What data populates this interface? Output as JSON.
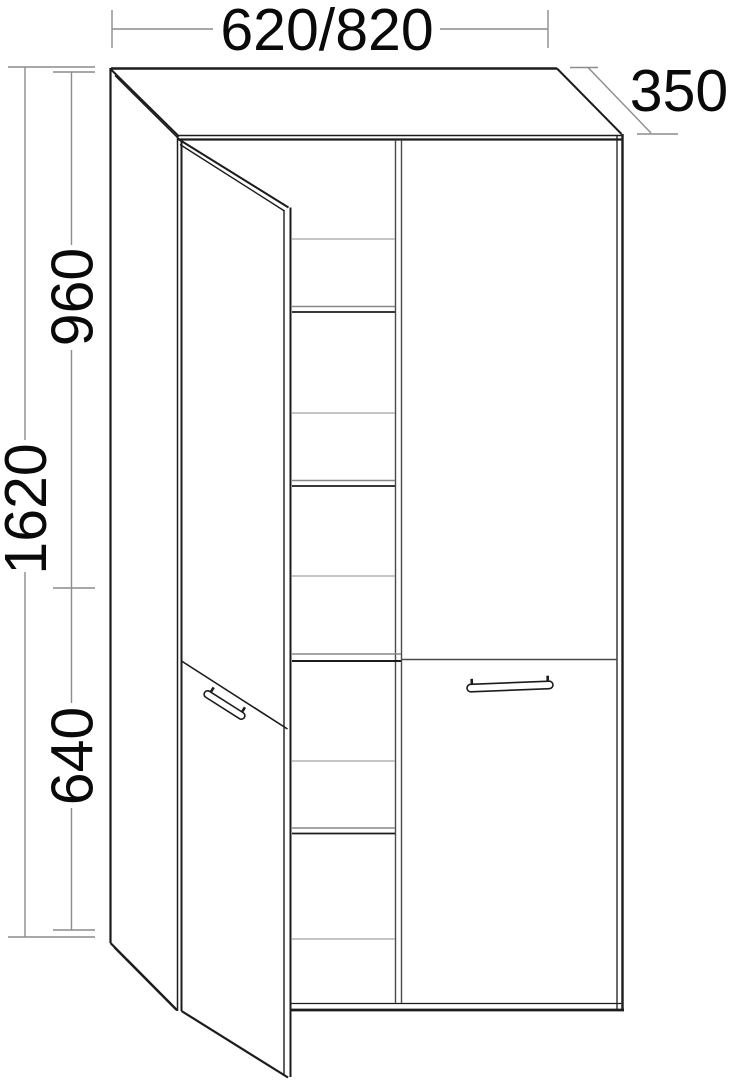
{
  "drawing_title": "tall-cabinet-technical-drawing",
  "dimensions": {
    "width": {
      "label": "620/820"
    },
    "depth": {
      "label": "350"
    },
    "height": {
      "label": "1620"
    },
    "upper_section": {
      "label": "960"
    },
    "lower_section": {
      "label": "640"
    }
  },
  "drawing": {
    "colors": {
      "black": "#1c1c1c",
      "dark": "#4a4a4a",
      "gray": "#8c8c8c",
      "shelf": "#a2a2a2",
      "shelfdark": "#878787",
      "background": "#ffffff",
      "text": "#0a0a0a"
    },
    "lines": [
      {
        "n": "top-back-edge",
        "x1": 111,
        "y1": 68.5,
        "x2": 557,
        "y2": 68.5,
        "w": 2.5,
        "c": "black"
      },
      {
        "n": "left-back-edge",
        "x1": 110.5,
        "y1": 68,
        "x2": 110.5,
        "y2": 943,
        "w": 2.2,
        "c": "black"
      },
      {
        "n": "top-left-diagonal-outer",
        "x1": 111,
        "y1": 69.5,
        "x2": 179,
        "y2": 136.5,
        "w": 2,
        "c": "black"
      },
      {
        "n": "top-left-diagonal-inner",
        "x1": 115,
        "y1": 75.5,
        "x2": 180,
        "y2": 140,
        "w": 1.5,
        "c": "black"
      },
      {
        "n": "front-top-edge-upper",
        "x1": 178,
        "y1": 135.5,
        "x2": 622,
        "y2": 135.5,
        "w": 1.5,
        "c": "black"
      },
      {
        "n": "front-top-edge-lower",
        "x1": 178,
        "y1": 139.5,
        "x2": 622,
        "y2": 139.5,
        "w": 2.2,
        "c": "black"
      },
      {
        "n": "top-right-diagonal",
        "x1": 557,
        "y1": 68.5,
        "x2": 621.5,
        "y2": 134,
        "w": 2,
        "c": "black"
      },
      {
        "n": "front-right-edge-inner",
        "x1": 617,
        "y1": 135.5,
        "x2": 617,
        "y2": 1009,
        "w": 1.3,
        "c": "black"
      },
      {
        "n": "front-right-edge-outer",
        "x1": 622.5,
        "y1": 134,
        "x2": 622.5,
        "y2": 1011,
        "w": 2.4,
        "c": "black"
      },
      {
        "n": "front-bottom-edge-upper",
        "x1": 291.5,
        "y1": 1003.5,
        "x2": 622.5,
        "y2": 1003.5,
        "w": 1.3,
        "c": "black"
      },
      {
        "n": "front-bottom-edge-lower",
        "x1": 291.5,
        "y1": 1010,
        "x2": 624,
        "y2": 1010,
        "w": 2.8,
        "c": "black"
      },
      {
        "n": "front-left-edge-outer",
        "x1": 177.5,
        "y1": 136,
        "x2": 177.5,
        "y2": 1011,
        "w": 1.5,
        "c": "black"
      },
      {
        "n": "front-left-edge-inner",
        "x1": 181.5,
        "y1": 140,
        "x2": 181.5,
        "y2": 1011,
        "w": 2,
        "c": "black"
      },
      {
        "n": "side-bottom-diagonal-outer",
        "x1": 110.5,
        "y1": 943,
        "x2": 177.5,
        "y2": 1010.5,
        "w": 2.2,
        "c": "black"
      },
      {
        "n": "side-bottom-diagonal-inner",
        "x1": 114,
        "y1": 947.5,
        "x2": 176,
        "y2": 1010,
        "w": 1.4,
        "c": "black"
      },
      {
        "n": "door-top-edge-outer",
        "x1": 179,
        "y1": 139.5,
        "x2": 288.5,
        "y2": 207.5,
        "w": 2,
        "c": "black"
      },
      {
        "n": "door-top-edge-inner",
        "x1": 180,
        "y1": 144.5,
        "x2": 284.5,
        "y2": 211,
        "w": 1.4,
        "c": "black"
      },
      {
        "n": "door-free-edge-inner",
        "x1": 284,
        "y1": 210,
        "x2": 284,
        "y2": 1076,
        "w": 1.4,
        "c": "black"
      },
      {
        "n": "door-free-edge-outer",
        "x1": 290.5,
        "y1": 207.5,
        "x2": 290.5,
        "y2": 1077,
        "w": 2,
        "c": "black"
      },
      {
        "n": "door-split-diagonal",
        "x1": 181.5,
        "y1": 661,
        "x2": 287.5,
        "y2": 729,
        "w": 1.6,
        "c": "black"
      },
      {
        "n": "door-bottom-edge",
        "x1": 181.5,
        "y1": 1011,
        "x2": 288,
        "y2": 1077.5,
        "w": 2.2,
        "c": "black"
      },
      {
        "n": "partition-edge-left",
        "x1": 395.5,
        "y1": 140,
        "x2": 395.5,
        "y2": 1003,
        "w": 1.4,
        "c": "dark"
      },
      {
        "n": "partition-edge-right",
        "x1": 401.5,
        "y1": 140,
        "x2": 401.5,
        "y2": 1003,
        "w": 1.4,
        "c": "dark"
      },
      {
        "n": "shelf1-back-edge",
        "x1": 292,
        "y1": 239,
        "x2": 395,
        "y2": 239,
        "w": 1.3,
        "c": "shelf"
      },
      {
        "n": "shelf1-front-top",
        "x1": 292,
        "y1": 306.5,
        "x2": 395,
        "y2": 306.5,
        "w": 1.6,
        "c": "shelfdark"
      },
      {
        "n": "shelf1-front-bottom",
        "x1": 292,
        "y1": 312,
        "x2": 395,
        "y2": 312,
        "w": 1.8,
        "c": "black"
      },
      {
        "n": "shelf2-back-edge",
        "x1": 292,
        "y1": 413,
        "x2": 395,
        "y2": 413,
        "w": 1.3,
        "c": "shelf"
      },
      {
        "n": "shelf2-front-top",
        "x1": 292,
        "y1": 480.5,
        "x2": 395,
        "y2": 480.5,
        "w": 1.6,
        "c": "shelfdark"
      },
      {
        "n": "shelf2-front-bottom",
        "x1": 292,
        "y1": 486,
        "x2": 395,
        "y2": 486,
        "w": 1.8,
        "c": "black"
      },
      {
        "n": "shelf3-back-edge",
        "x1": 292,
        "y1": 576,
        "x2": 395,
        "y2": 576,
        "w": 1.3,
        "c": "shelf"
      },
      {
        "n": "mid-shelf-front-top",
        "x1": 292,
        "y1": 654,
        "x2": 401,
        "y2": 654,
        "w": 1.6,
        "c": "shelfdark"
      },
      {
        "n": "mid-shelf-front-bottom",
        "x1": 292,
        "y1": 661,
        "x2": 401,
        "y2": 661,
        "w": 2,
        "c": "black"
      },
      {
        "n": "shelf4-back-edge",
        "x1": 292,
        "y1": 761,
        "x2": 395,
        "y2": 761,
        "w": 1.3,
        "c": "shelf"
      },
      {
        "n": "shelf4-front-top",
        "x1": 292,
        "y1": 828,
        "x2": 395,
        "y2": 828,
        "w": 1.6,
        "c": "shelfdark"
      },
      {
        "n": "shelf4-front-bottom",
        "x1": 292,
        "y1": 833.5,
        "x2": 395,
        "y2": 833.5,
        "w": 1.8,
        "c": "black"
      },
      {
        "n": "shelf5-back-edge",
        "x1": 292,
        "y1": 939,
        "x2": 395,
        "y2": 939,
        "w": 1.3,
        "c": "shelf"
      },
      {
        "n": "right-door-split",
        "x1": 402,
        "y1": 659.5,
        "x2": 617,
        "y2": 659.5,
        "w": 1.5,
        "c": "dark"
      },
      {
        "n": "width-dim-tick-left",
        "x1": 112,
        "y1": 10,
        "x2": 112,
        "y2": 48,
        "w": 1.4,
        "c": "gray"
      },
      {
        "n": "width-dim-tick-right",
        "x1": 548,
        "y1": 10,
        "x2": 548,
        "y2": 48,
        "w": 1.4,
        "c": "gray"
      },
      {
        "n": "width-dim-line-left",
        "x1": 112,
        "y1": 29,
        "x2": 213,
        "y2": 29,
        "w": 1.4,
        "c": "gray"
      },
      {
        "n": "width-dim-line-right",
        "x1": 440,
        "y1": 29,
        "x2": 548,
        "y2": 29,
        "w": 1.4,
        "c": "gray"
      },
      {
        "n": "depth-dim-tick-top",
        "x1": 570,
        "y1": 67.5,
        "x2": 598,
        "y2": 67.5,
        "w": 1.4,
        "c": "gray"
      },
      {
        "n": "depth-dim-tick-bottom",
        "x1": 637,
        "y1": 134,
        "x2": 678,
        "y2": 134,
        "w": 1.4,
        "c": "gray"
      },
      {
        "n": "depth-dim-line",
        "x1": 588,
        "y1": 67.5,
        "x2": 651,
        "y2": 133,
        "w": 1.4,
        "c": "gray"
      },
      {
        "n": "height-ext-line-top",
        "x1": 8,
        "y1": 67,
        "x2": 95,
        "y2": 67,
        "w": 1.4,
        "c": "gray"
      },
      {
        "n": "height-ext-line-bottom",
        "x1": 8,
        "y1": 937,
        "x2": 95,
        "y2": 937,
        "w": 1.4,
        "c": "gray"
      },
      {
        "n": "height-dim-line-upper",
        "x1": 25,
        "y1": 67,
        "x2": 25,
        "y2": 440,
        "w": 1.4,
        "c": "gray"
      },
      {
        "n": "height-dim-line-lower",
        "x1": 25,
        "y1": 572,
        "x2": 25,
        "y2": 937,
        "w": 1.4,
        "c": "gray"
      },
      {
        "n": "upper-dim-tick-top",
        "x1": 53,
        "y1": 72,
        "x2": 95,
        "y2": 72,
        "w": 1.4,
        "c": "gray"
      },
      {
        "n": "split-dim-tick",
        "x1": 53,
        "y1": 588,
        "x2": 95,
        "y2": 588,
        "w": 1.4,
        "c": "gray"
      },
      {
        "n": "lower-dim-tick-bottom",
        "x1": 53,
        "y1": 930,
        "x2": 95,
        "y2": 930,
        "w": 1.4,
        "c": "gray"
      },
      {
        "n": "upper-dim-line-top",
        "x1": 71.5,
        "y1": 72,
        "x2": 71.5,
        "y2": 245,
        "w": 1.4,
        "c": "gray"
      },
      {
        "n": "upper-dim-line-bottom",
        "x1": 71.5,
        "y1": 350,
        "x2": 71.5,
        "y2": 588,
        "w": 1.4,
        "c": "gray"
      },
      {
        "n": "lower-dim-line-top",
        "x1": 71.5,
        "y1": 588,
        "x2": 71.5,
        "y2": 703,
        "w": 1.4,
        "c": "gray"
      },
      {
        "n": "lower-dim-line-bottom",
        "x1": 71.5,
        "y1": 808,
        "x2": 71.5,
        "y2": 930,
        "w": 1.4,
        "c": "gray"
      }
    ],
    "handles": [
      {
        "n": "left-door-handle",
        "cx": 224.5,
        "cy": 705,
        "len": 47,
        "th": 7,
        "angle": 32.4
      },
      {
        "n": "right-door-handle",
        "cx": 510,
        "cy": 686.5,
        "len": 86,
        "th": 7.5,
        "angle": -2.3
      }
    ]
  }
}
